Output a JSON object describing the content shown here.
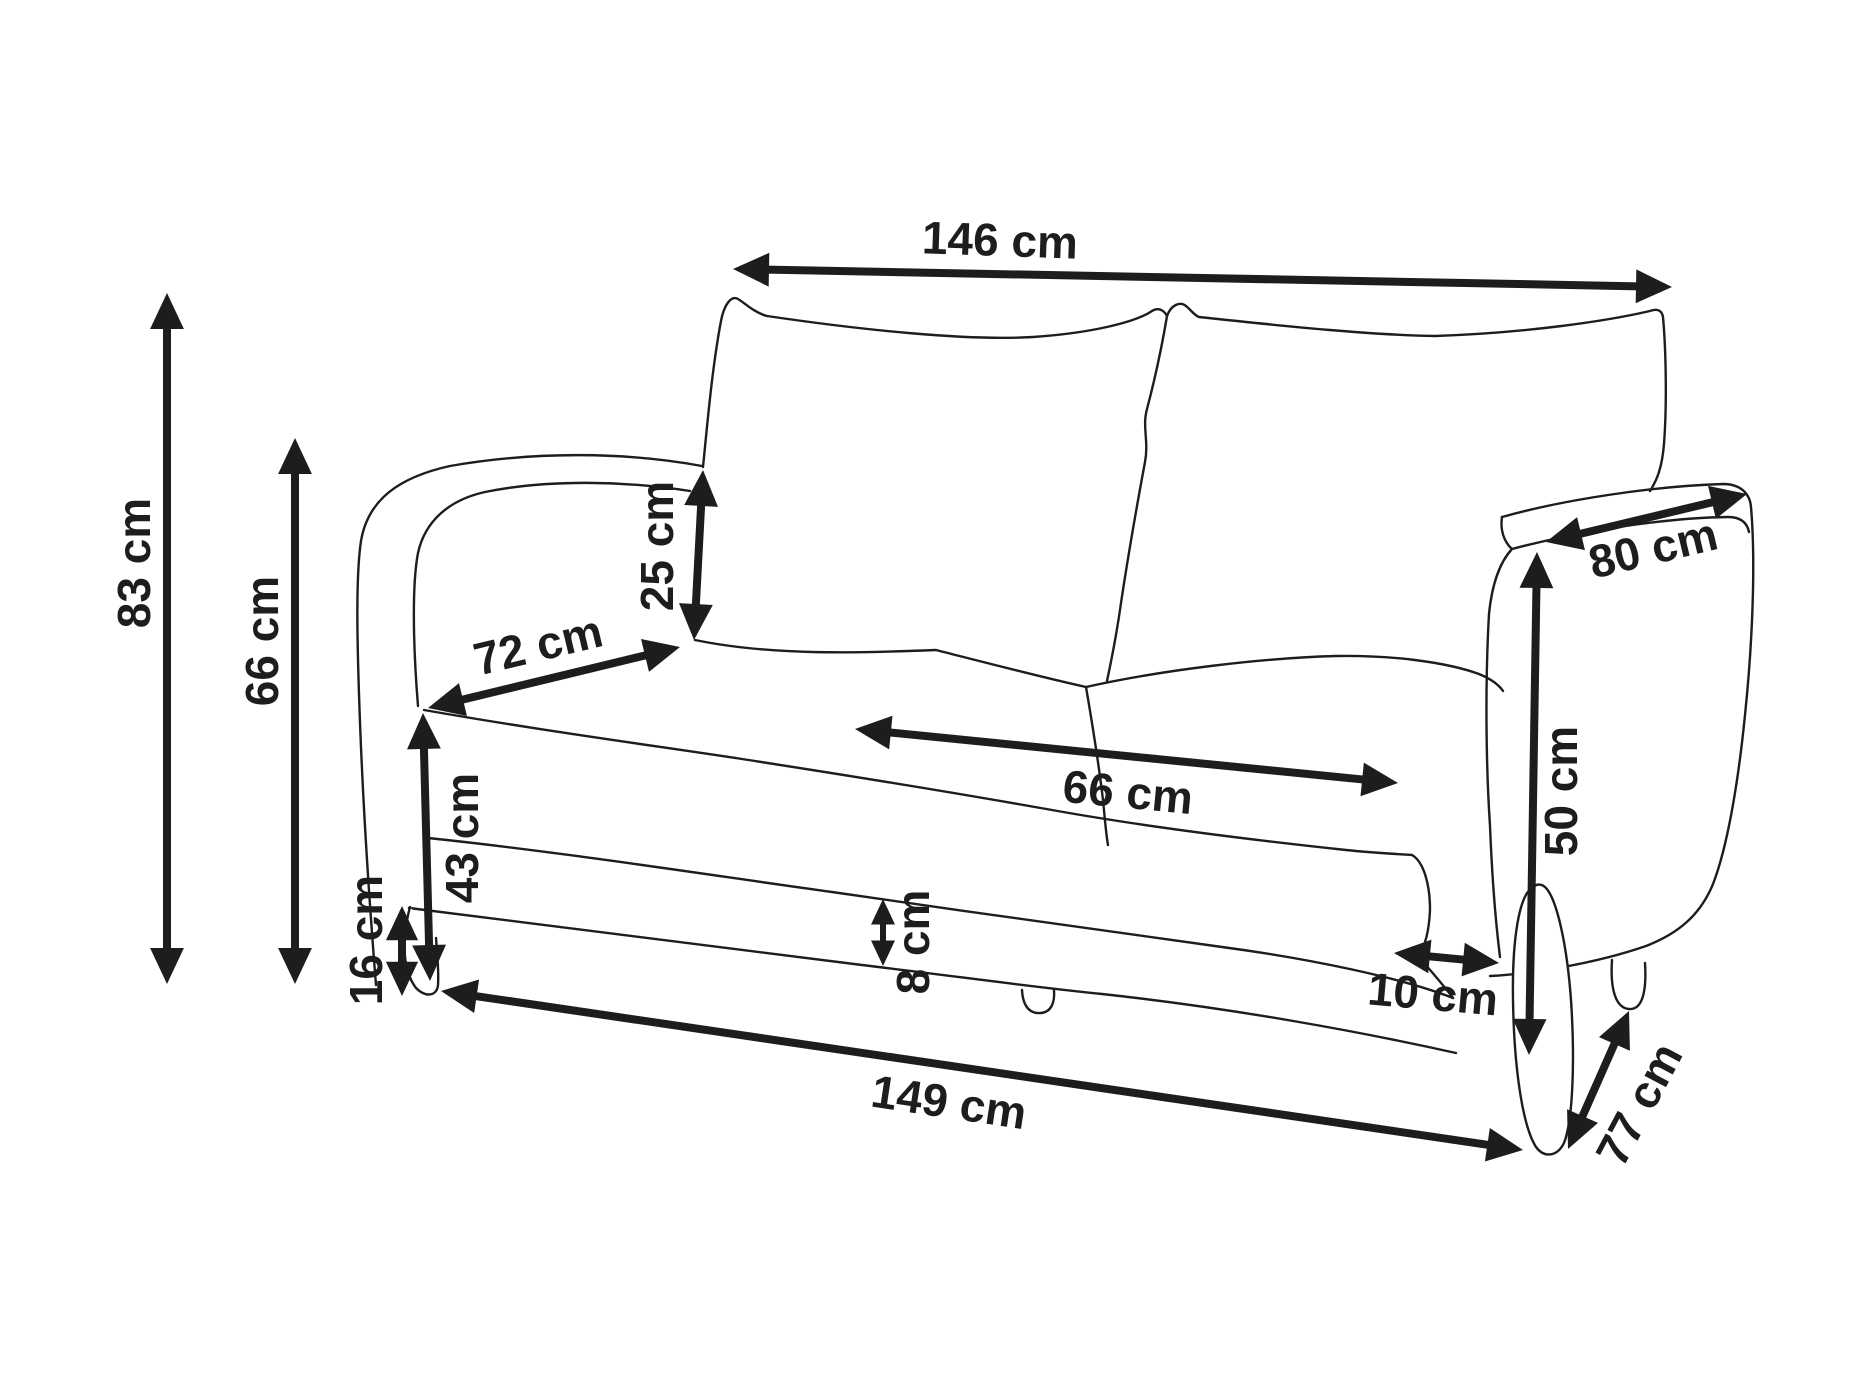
{
  "diagram": {
    "type": "furniture-dimension-diagram",
    "subject": "two-seat sofa line drawing with dimension arrows",
    "unit": "cm",
    "ink_color": "#1d1d1b",
    "background_color": "#ffffff"
  },
  "measurements": [
    {
      "id": "back-width",
      "label": "146 cm",
      "value_cm": 146,
      "x1": 733,
      "y1": 269,
      "x2": 1672,
      "y2": 287,
      "lx": 1000,
      "ly": 240,
      "rot": 2,
      "fs": 46
    },
    {
      "id": "overall-height",
      "label": "83 cm",
      "value_cm": 83,
      "x1": 167,
      "y1": 293,
      "x2": 167,
      "y2": 984,
      "lx": 134,
      "ly": 563,
      "rot": -90,
      "fs": 46
    },
    {
      "id": "armrest-height",
      "label": "66 cm",
      "value_cm": 66,
      "x1": 295,
      "y1": 438,
      "x2": 295,
      "y2": 984,
      "lx": 262,
      "ly": 641,
      "rot": -90,
      "fs": 46
    },
    {
      "id": "backrest-above-seat",
      "label": "25 cm",
      "value_cm": 25,
      "x1": 703,
      "y1": 470,
      "x2": 694,
      "y2": 640,
      "lx": 657,
      "ly": 546,
      "rot": -90,
      "fs": 46
    },
    {
      "id": "armrest-length",
      "label": "72 cm",
      "value_cm": 72,
      "x1": 428,
      "y1": 708,
      "x2": 680,
      "y2": 647,
      "lx": 538,
      "ly": 645,
      "rot": -13.5,
      "fs": 46
    },
    {
      "id": "seat-height",
      "label": "43 cm",
      "value_cm": 43,
      "x1": 423,
      "y1": 713,
      "x2": 430,
      "y2": 981,
      "lx": 462,
      "ly": 838,
      "rot": -90,
      "fs": 46
    },
    {
      "id": "leg-height",
      "label": "16 cm",
      "value_cm": 16,
      "x1": 402,
      "y1": 906,
      "x2": 402,
      "y2": 996,
      "lx": 366,
      "ly": 940,
      "rot": -90,
      "fs": 46
    },
    {
      "id": "base-height",
      "label": "8 cm",
      "value_cm": 8,
      "x1": 883,
      "y1": 899,
      "x2": 883,
      "y2": 966,
      "lx": 913,
      "ly": 942,
      "rot": -90,
      "fs": 46
    },
    {
      "id": "seat-width",
      "label": "66 cm",
      "value_cm": 66,
      "x1": 855,
      "y1": 729,
      "x2": 1398,
      "y2": 783,
      "lx": 1128,
      "ly": 792,
      "rot": 5.5,
      "fs": 46
    },
    {
      "id": "arm-top-depth",
      "label": "80 cm",
      "value_cm": 80,
      "x1": 1546,
      "y1": 542,
      "x2": 1747,
      "y2": 494,
      "lx": 1653,
      "ly": 548,
      "rot": -13.5,
      "fs": 46
    },
    {
      "id": "arm-side-height",
      "label": "50 cm",
      "value_cm": 50,
      "x1": 1537,
      "y1": 552,
      "x2": 1529,
      "y2": 1055,
      "lx": 1561,
      "ly": 791,
      "rot": -90,
      "fs": 46
    },
    {
      "id": "armrest-thickness",
      "label": "10 cm",
      "value_cm": 10,
      "x1": 1394,
      "y1": 953,
      "x2": 1499,
      "y2": 963,
      "lx": 1433,
      "ly": 994,
      "rot": 5,
      "fs": 46
    },
    {
      "id": "overall-width",
      "label": "149 cm",
      "value_cm": 149,
      "x1": 441,
      "y1": 991,
      "x2": 1523,
      "y2": 1150,
      "lx": 949,
      "ly": 1102,
      "rot": 8.5,
      "fs": 46
    },
    {
      "id": "overall-depth",
      "label": "77 cm",
      "value_cm": 77,
      "x1": 1568,
      "y1": 1149,
      "x2": 1629,
      "y2": 1011,
      "lx": 1639,
      "ly": 1104,
      "rot": -62,
      "fs": 46
    }
  ]
}
